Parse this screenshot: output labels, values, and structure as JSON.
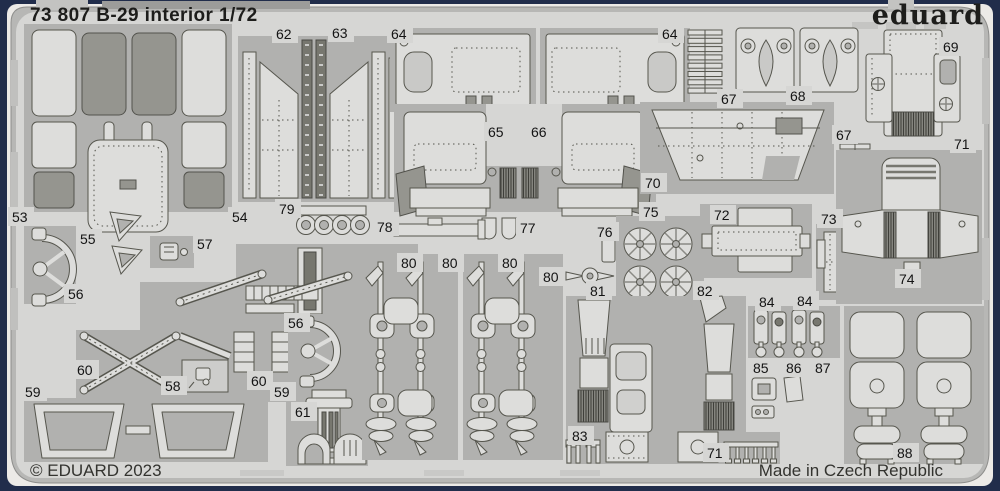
{
  "header": {
    "title": "73 807 B-29 interior 1/72",
    "brand_logo": "eduard"
  },
  "footer": {
    "copyright": "© EDUARD 2023",
    "made_in": "Made in Czech Republic"
  },
  "sheet": {
    "colors": {
      "border": "#212d4b",
      "field": "#d6d6d4",
      "waste_frame": "#b1b1af",
      "part": "#dddddb",
      "text": "#141414"
    },
    "part_labels": [
      {
        "n": "53",
        "x": 12,
        "y": 209
      },
      {
        "n": "54",
        "x": 232,
        "y": 209
      },
      {
        "n": "55",
        "x": 80,
        "y": 231
      },
      {
        "n": "56",
        "x": 68,
        "y": 286
      },
      {
        "n": "56",
        "x": 288,
        "y": 315
      },
      {
        "n": "57",
        "x": 197,
        "y": 236
      },
      {
        "n": "58",
        "x": 165,
        "y": 378
      },
      {
        "n": "59",
        "x": 25,
        "y": 384
      },
      {
        "n": "59",
        "x": 274,
        "y": 384
      },
      {
        "n": "60",
        "x": 77,
        "y": 362
      },
      {
        "n": "60",
        "x": 251,
        "y": 373
      },
      {
        "n": "61",
        "x": 295,
        "y": 404
      },
      {
        "n": "62",
        "x": 276,
        "y": 26
      },
      {
        "n": "63",
        "x": 332,
        "y": 25
      },
      {
        "n": "64",
        "x": 391,
        "y": 26
      },
      {
        "n": "64",
        "x": 662,
        "y": 26
      },
      {
        "n": "65",
        "x": 488,
        "y": 124
      },
      {
        "n": "66",
        "x": 531,
        "y": 124
      },
      {
        "n": "67",
        "x": 721,
        "y": 91
      },
      {
        "n": "67",
        "x": 836,
        "y": 127
      },
      {
        "n": "68",
        "x": 790,
        "y": 88
      },
      {
        "n": "69",
        "x": 943,
        "y": 39
      },
      {
        "n": "70",
        "x": 645,
        "y": 175
      },
      {
        "n": "71",
        "x": 954,
        "y": 136
      },
      {
        "n": "71",
        "x": 707,
        "y": 445
      },
      {
        "n": "72",
        "x": 714,
        "y": 207
      },
      {
        "n": "73",
        "x": 821,
        "y": 211
      },
      {
        "n": "74",
        "x": 899,
        "y": 271
      },
      {
        "n": "75",
        "x": 643,
        "y": 204
      },
      {
        "n": "76",
        "x": 597,
        "y": 224
      },
      {
        "n": "77",
        "x": 520,
        "y": 220
      },
      {
        "n": "78",
        "x": 377,
        "y": 219
      },
      {
        "n": "79",
        "x": 279,
        "y": 201
      },
      {
        "n": "80",
        "x": 401,
        "y": 255
      },
      {
        "n": "80",
        "x": 442,
        "y": 255
      },
      {
        "n": "80",
        "x": 502,
        "y": 255
      },
      {
        "n": "80",
        "x": 543,
        "y": 269
      },
      {
        "n": "81",
        "x": 590,
        "y": 283
      },
      {
        "n": "82",
        "x": 697,
        "y": 283
      },
      {
        "n": "83",
        "x": 572,
        "y": 428
      },
      {
        "n": "84",
        "x": 759,
        "y": 294
      },
      {
        "n": "84",
        "x": 797,
        "y": 293
      },
      {
        "n": "85",
        "x": 753,
        "y": 360
      },
      {
        "n": "86",
        "x": 786,
        "y": 360
      },
      {
        "n": "87",
        "x": 815,
        "y": 360
      },
      {
        "n": "88",
        "x": 897,
        "y": 445
      }
    ]
  }
}
